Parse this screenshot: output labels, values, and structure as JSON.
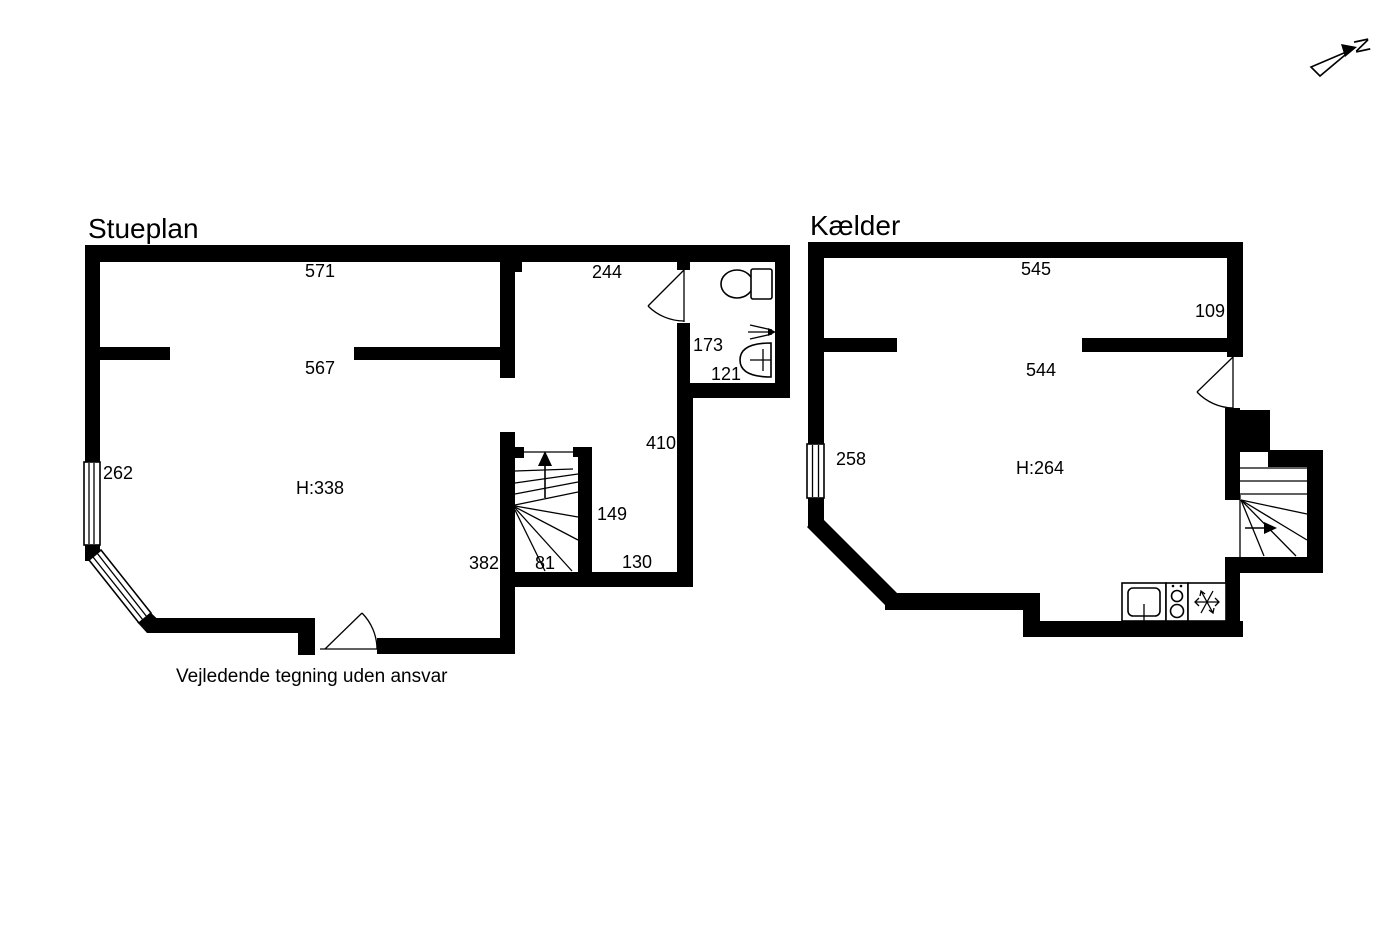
{
  "drawing": {
    "background": "#ffffff",
    "ink": "#000000",
    "disclaimer": "Vejledende tegning uden ansvar",
    "compass_north": "N"
  },
  "stueplan": {
    "title": "Stueplan",
    "ceiling_height": "H:338",
    "dims": {
      "top_width": "571",
      "hall_width": "244",
      "room_width": "567",
      "bath_depth": "173",
      "bath_width": "121",
      "window_left": "262",
      "hall_length": "410",
      "stair_depth": "149",
      "room_bottom": "382",
      "stair_width": "81",
      "hall_bottom": "130"
    }
  },
  "kaelder": {
    "title": "Kælder",
    "ceiling_height": "H:264",
    "dims": {
      "top_width": "545",
      "right_side": "109",
      "room_width": "544",
      "window_left": "258"
    }
  }
}
